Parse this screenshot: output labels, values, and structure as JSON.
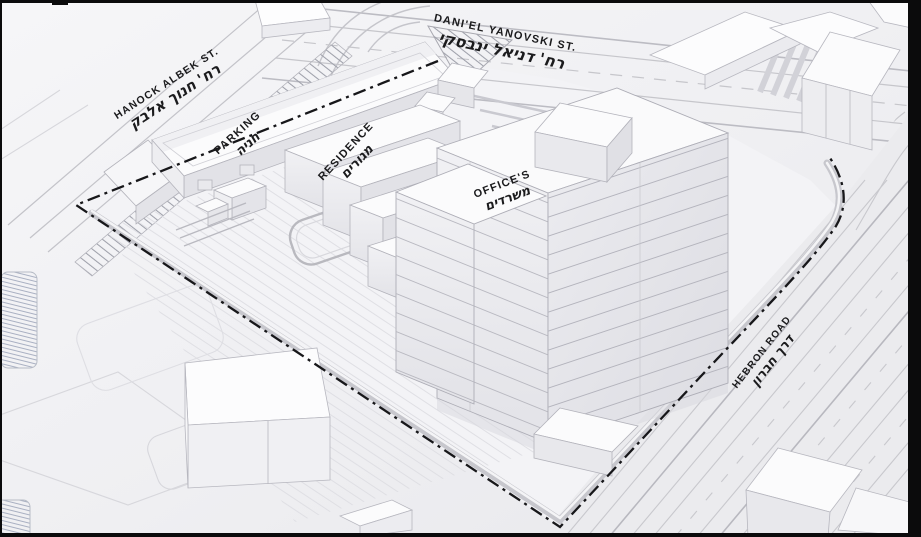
{
  "streets": {
    "hanock": {
      "en": "HANOCK ALBEK ST.",
      "he": "רח' חנוך אלבק"
    },
    "daniel": {
      "en": "DANI'EL YANOVSKI ST.",
      "he": "רח' דניאל ינבסקי"
    },
    "hebron": {
      "en": "HEBRON ROAD",
      "he": "דרך חברון"
    }
  },
  "buildings": {
    "parking": {
      "en": "PARKING",
      "he": "חניה"
    },
    "residence": {
      "en": "RESIDENCE",
      "he": "מגורים"
    },
    "offices": {
      "en": "OFFICE'S",
      "he": "משרדים"
    }
  },
  "colors": {
    "background": "#eeeef0",
    "building_white": "#fbfbfc",
    "shade_light": "#ededf0",
    "shade_dark": "#e2e2e7",
    "outline": "#b0b0b8",
    "label": "#1b1b1d",
    "boundary": "#17171a",
    "wall": "#c9c9cf"
  }
}
